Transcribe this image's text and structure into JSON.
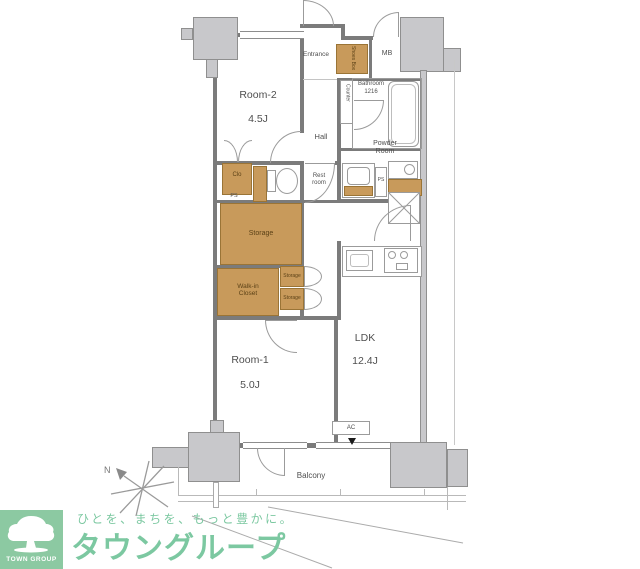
{
  "plan": {
    "unit_labels": {
      "room2_name": "Room-2",
      "room2_size": "4.5J",
      "room1_name": "Room-1",
      "room1_size": "5.0J",
      "ldk_name": "LDK",
      "ldk_size": "12.4J",
      "entrance": "Entrance",
      "hall": "Hall",
      "mb": "MB",
      "counter": "Counter",
      "shoes_box": "Shoes Box",
      "bathroom": "Bathroom",
      "bathroom_size": "1216",
      "powder_room_line1": "Powder",
      "powder_room_line2": "Room",
      "rest_room_line1": "Rest",
      "rest_room_line2": "room",
      "closet": "Clo",
      "ps_hall": "PS",
      "ps_powder": "PS",
      "storage_main": "Storage",
      "storage_upper": "Storage",
      "storage_lower": "Storage",
      "walk_in_line1": "Walk-in",
      "walk_in_line2": "Closet",
      "ac": "AC",
      "balcony": "Balcony",
      "north": "N"
    },
    "icons": {
      "bathtub": "rounded-rect tub",
      "toilet": "tank+bowl",
      "washbasin": "vanity with bowl",
      "washing_machine": "drum box",
      "refrigerator": "x-cross square",
      "kitchen": "sink + 2-burner stove",
      "compass": "asterisk star with N arrow"
    }
  },
  "logo": {
    "badge": "TOWN GROUP",
    "tagline": "ひとを、まちを、もっと豊かに。",
    "brand": "タウングループ"
  },
  "colors": {
    "wall": "#7b7b7b",
    "pillar_fill": "#c8c8cb",
    "storage_fill": "#c89a5b",
    "storage_border": "#9a7436",
    "logo_green": "#7cc8a1",
    "logo_square": "#8cc9a2"
  }
}
